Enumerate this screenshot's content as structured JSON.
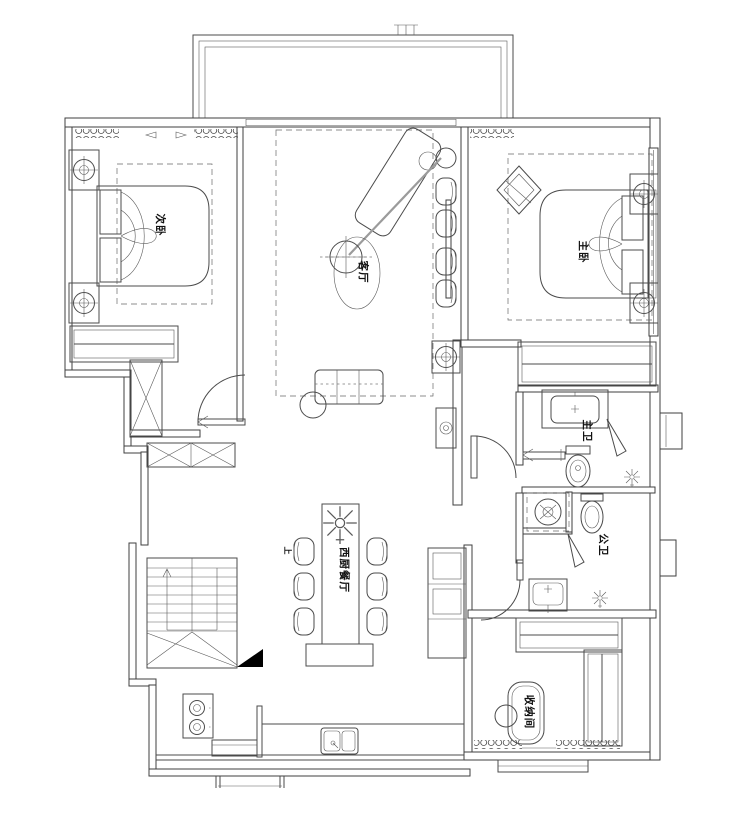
{
  "colors": {
    "line": "#4b4b4b",
    "wall": "#3f3f3f",
    "text": "#111111",
    "paper": "#ffffff",
    "solid_fill": "#000000"
  },
  "rooms": {
    "secondary_bedroom": {
      "label": "次卧"
    },
    "living_room": {
      "label": "客厅"
    },
    "master_bedroom": {
      "label": "主卧"
    },
    "master_bathroom": {
      "label": "主卫"
    },
    "guest_bathroom": {
      "label": "公卫"
    },
    "western_kitchen_dining": {
      "label": "西厨餐厅"
    },
    "storage_room": {
      "label": "收纳间"
    }
  },
  "annotations": {
    "stairs_direction": {
      "label": "上"
    }
  }
}
